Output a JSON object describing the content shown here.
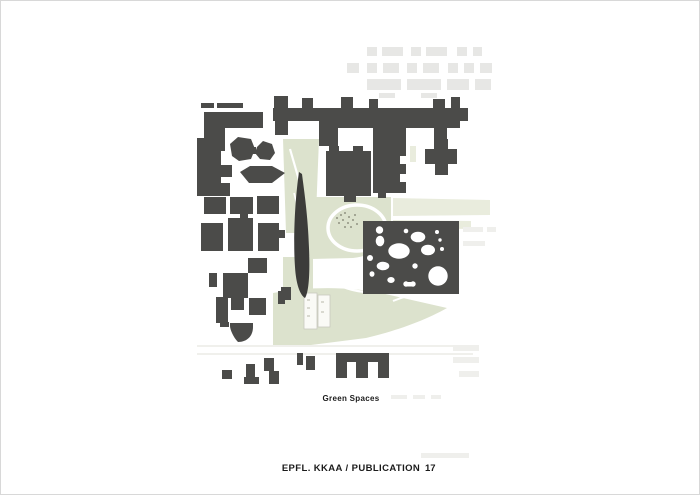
{
  "page": {
    "background": "#ffffff",
    "border_color": "#d8d8d8"
  },
  "figure": {
    "caption": "Green Spaces",
    "type": "campus-site-plan",
    "colors": {
      "building": "#4b4b49",
      "building_dark": "#3c3c3a",
      "ghost_building": "#e7e7e5",
      "green_space": "#dce2cd",
      "green_soft": "#e9ecdd",
      "path_white": "#ffffff",
      "road_line": "#e0e0d9"
    },
    "map_elements": {
      "green_spaces": "light green areas",
      "buildings": "dark grey figure-ground blocks",
      "perforated_building": "rectangle with round white voids"
    }
  },
  "footer": {
    "publication": "EPFL. KKAA / PUBLICATION",
    "page_number": "17"
  }
}
